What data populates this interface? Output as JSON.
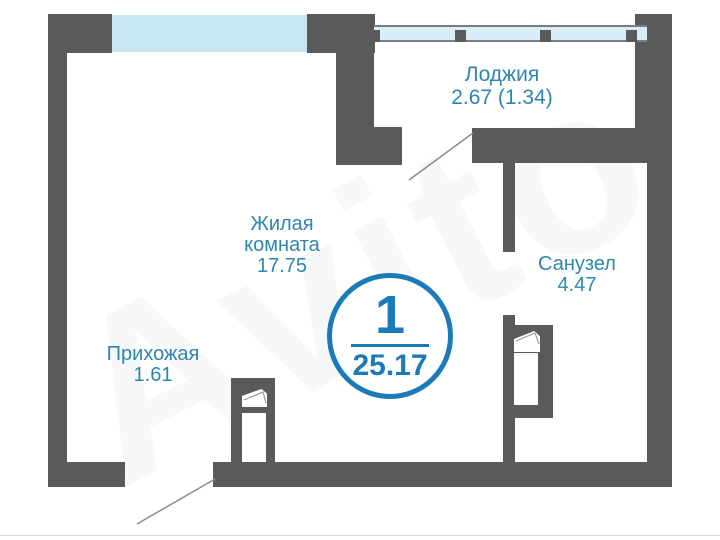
{
  "plan": {
    "rooms": [
      {
        "id": "living",
        "name": "Жилая комната",
        "area": "17.75"
      },
      {
        "id": "hall",
        "name": "Прихожая",
        "area": "1.61"
      },
      {
        "id": "loggia",
        "name": "Лоджия",
        "area": "2.67 (1.34)"
      },
      {
        "id": "bath",
        "name": "Санузел",
        "area": "4.47"
      }
    ],
    "badge": {
      "rooms_count": "1",
      "total_area": "25.17"
    },
    "watermark": "Avito",
    "colors": {
      "wall": "#595a5c",
      "window": "#c9e6f3",
      "railing_fill": "#d8edf8",
      "label_text": "#2e86ae",
      "badge_accent": "#1d7ab8",
      "door_line": "#8b8b8b"
    }
  }
}
